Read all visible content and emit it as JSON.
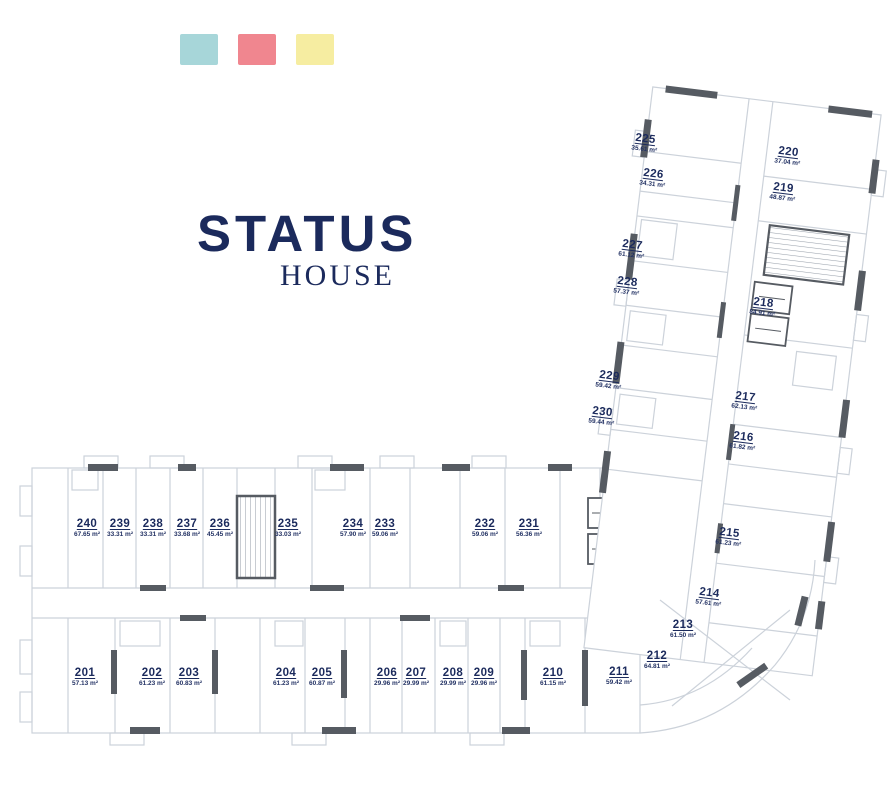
{
  "legend": {
    "swatches": [
      {
        "name": "teal",
        "color": "#a7d6d9"
      },
      {
        "name": "pink",
        "color": "#f0868f"
      },
      {
        "name": "yellow",
        "color": "#f6eda1"
      }
    ]
  },
  "logo": {
    "title": "STATUS",
    "subtitle": "HOUSE",
    "color": "#1b2a5c"
  },
  "plan": {
    "colors": {
      "unit_text": "#1b2a5c",
      "walls_dark": "#565b62",
      "lines_light": "#ccd2da"
    },
    "units": [
      {
        "number": "201",
        "area": "57.13 m²",
        "x": 85,
        "y": 677,
        "rot": 0
      },
      {
        "number": "202",
        "area": "61.23 m²",
        "x": 152,
        "y": 677,
        "rot": 0
      },
      {
        "number": "203",
        "area": "60.83 m²",
        "x": 189,
        "y": 677,
        "rot": 0
      },
      {
        "number": "204",
        "area": "61.23 m²",
        "x": 286,
        "y": 677,
        "rot": 0
      },
      {
        "number": "205",
        "area": "60.87 m²",
        "x": 322,
        "y": 677,
        "rot": 0
      },
      {
        "number": "206",
        "area": "29.96 m²",
        "x": 387,
        "y": 677,
        "rot": 0
      },
      {
        "number": "207",
        "area": "29.99 m²",
        "x": 416,
        "y": 677,
        "rot": 0
      },
      {
        "number": "208",
        "area": "29.99 m²",
        "x": 453,
        "y": 677,
        "rot": 0
      },
      {
        "number": "209",
        "area": "29.96 m²",
        "x": 484,
        "y": 677,
        "rot": 0
      },
      {
        "number": "210",
        "area": "61.15 m²",
        "x": 553,
        "y": 677,
        "rot": 0
      },
      {
        "number": "211",
        "area": "59.42 m²",
        "x": 619,
        "y": 676,
        "rot": 0
      },
      {
        "number": "212",
        "area": "64.81 m²",
        "x": 657,
        "y": 660,
        "rot": 0
      },
      {
        "number": "213",
        "area": "61.50 m²",
        "x": 683,
        "y": 629,
        "rot": 0
      },
      {
        "number": "214",
        "area": "57.61 m²",
        "x": 709,
        "y": 597,
        "rot": 7
      },
      {
        "number": "215",
        "area": "61.23 m²",
        "x": 729,
        "y": 537,
        "rot": 7
      },
      {
        "number": "216",
        "area": "61.82 m²",
        "x": 743,
        "y": 441,
        "rot": 7
      },
      {
        "number": "217",
        "area": "62.13 m²",
        "x": 745,
        "y": 401,
        "rot": 7
      },
      {
        "number": "218",
        "area": "84.91 m²",
        "x": 763,
        "y": 307,
        "rot": 7
      },
      {
        "number": "219",
        "area": "48.87 m²",
        "x": 783,
        "y": 192,
        "rot": 7
      },
      {
        "number": "220",
        "area": "37.04 m²",
        "x": 788,
        "y": 156,
        "rot": 7
      },
      {
        "number": "225",
        "area": "35.61 m²",
        "x": 645,
        "y": 143,
        "rot": 7
      },
      {
        "number": "226",
        "area": "34.31 m²",
        "x": 653,
        "y": 178,
        "rot": 7
      },
      {
        "number": "227",
        "area": "61.12 m²",
        "x": 632,
        "y": 249,
        "rot": 7
      },
      {
        "number": "228",
        "area": "57.37 m²",
        "x": 627,
        "y": 286,
        "rot": 7
      },
      {
        "number": "229",
        "area": "59.42 m²",
        "x": 609,
        "y": 380,
        "rot": 7
      },
      {
        "number": "230",
        "area": "59.44 m²",
        "x": 602,
        "y": 416,
        "rot": 7
      },
      {
        "number": "231",
        "area": "56.36 m²",
        "x": 529,
        "y": 528,
        "rot": 0
      },
      {
        "number": "232",
        "area": "59.06 m²",
        "x": 485,
        "y": 528,
        "rot": 0
      },
      {
        "number": "233",
        "area": "59.06 m²",
        "x": 385,
        "y": 528,
        "rot": 0
      },
      {
        "number": "234",
        "area": "57.90 m²",
        "x": 353,
        "y": 528,
        "rot": 0
      },
      {
        "number": "235",
        "area": "33.03 m²",
        "x": 288,
        "y": 528,
        "rot": 0
      },
      {
        "number": "236",
        "area": "45.45 m²",
        "x": 220,
        "y": 528,
        "rot": 0
      },
      {
        "number": "237",
        "area": "33.68 m²",
        "x": 187,
        "y": 528,
        "rot": 0
      },
      {
        "number": "238",
        "area": "33.31 m²",
        "x": 153,
        "y": 528,
        "rot": 0
      },
      {
        "number": "239",
        "area": "33.31 m²",
        "x": 120,
        "y": 528,
        "rot": 0
      },
      {
        "number": "240",
        "area": "67.65 m²",
        "x": 87,
        "y": 528,
        "rot": 0
      }
    ]
  }
}
